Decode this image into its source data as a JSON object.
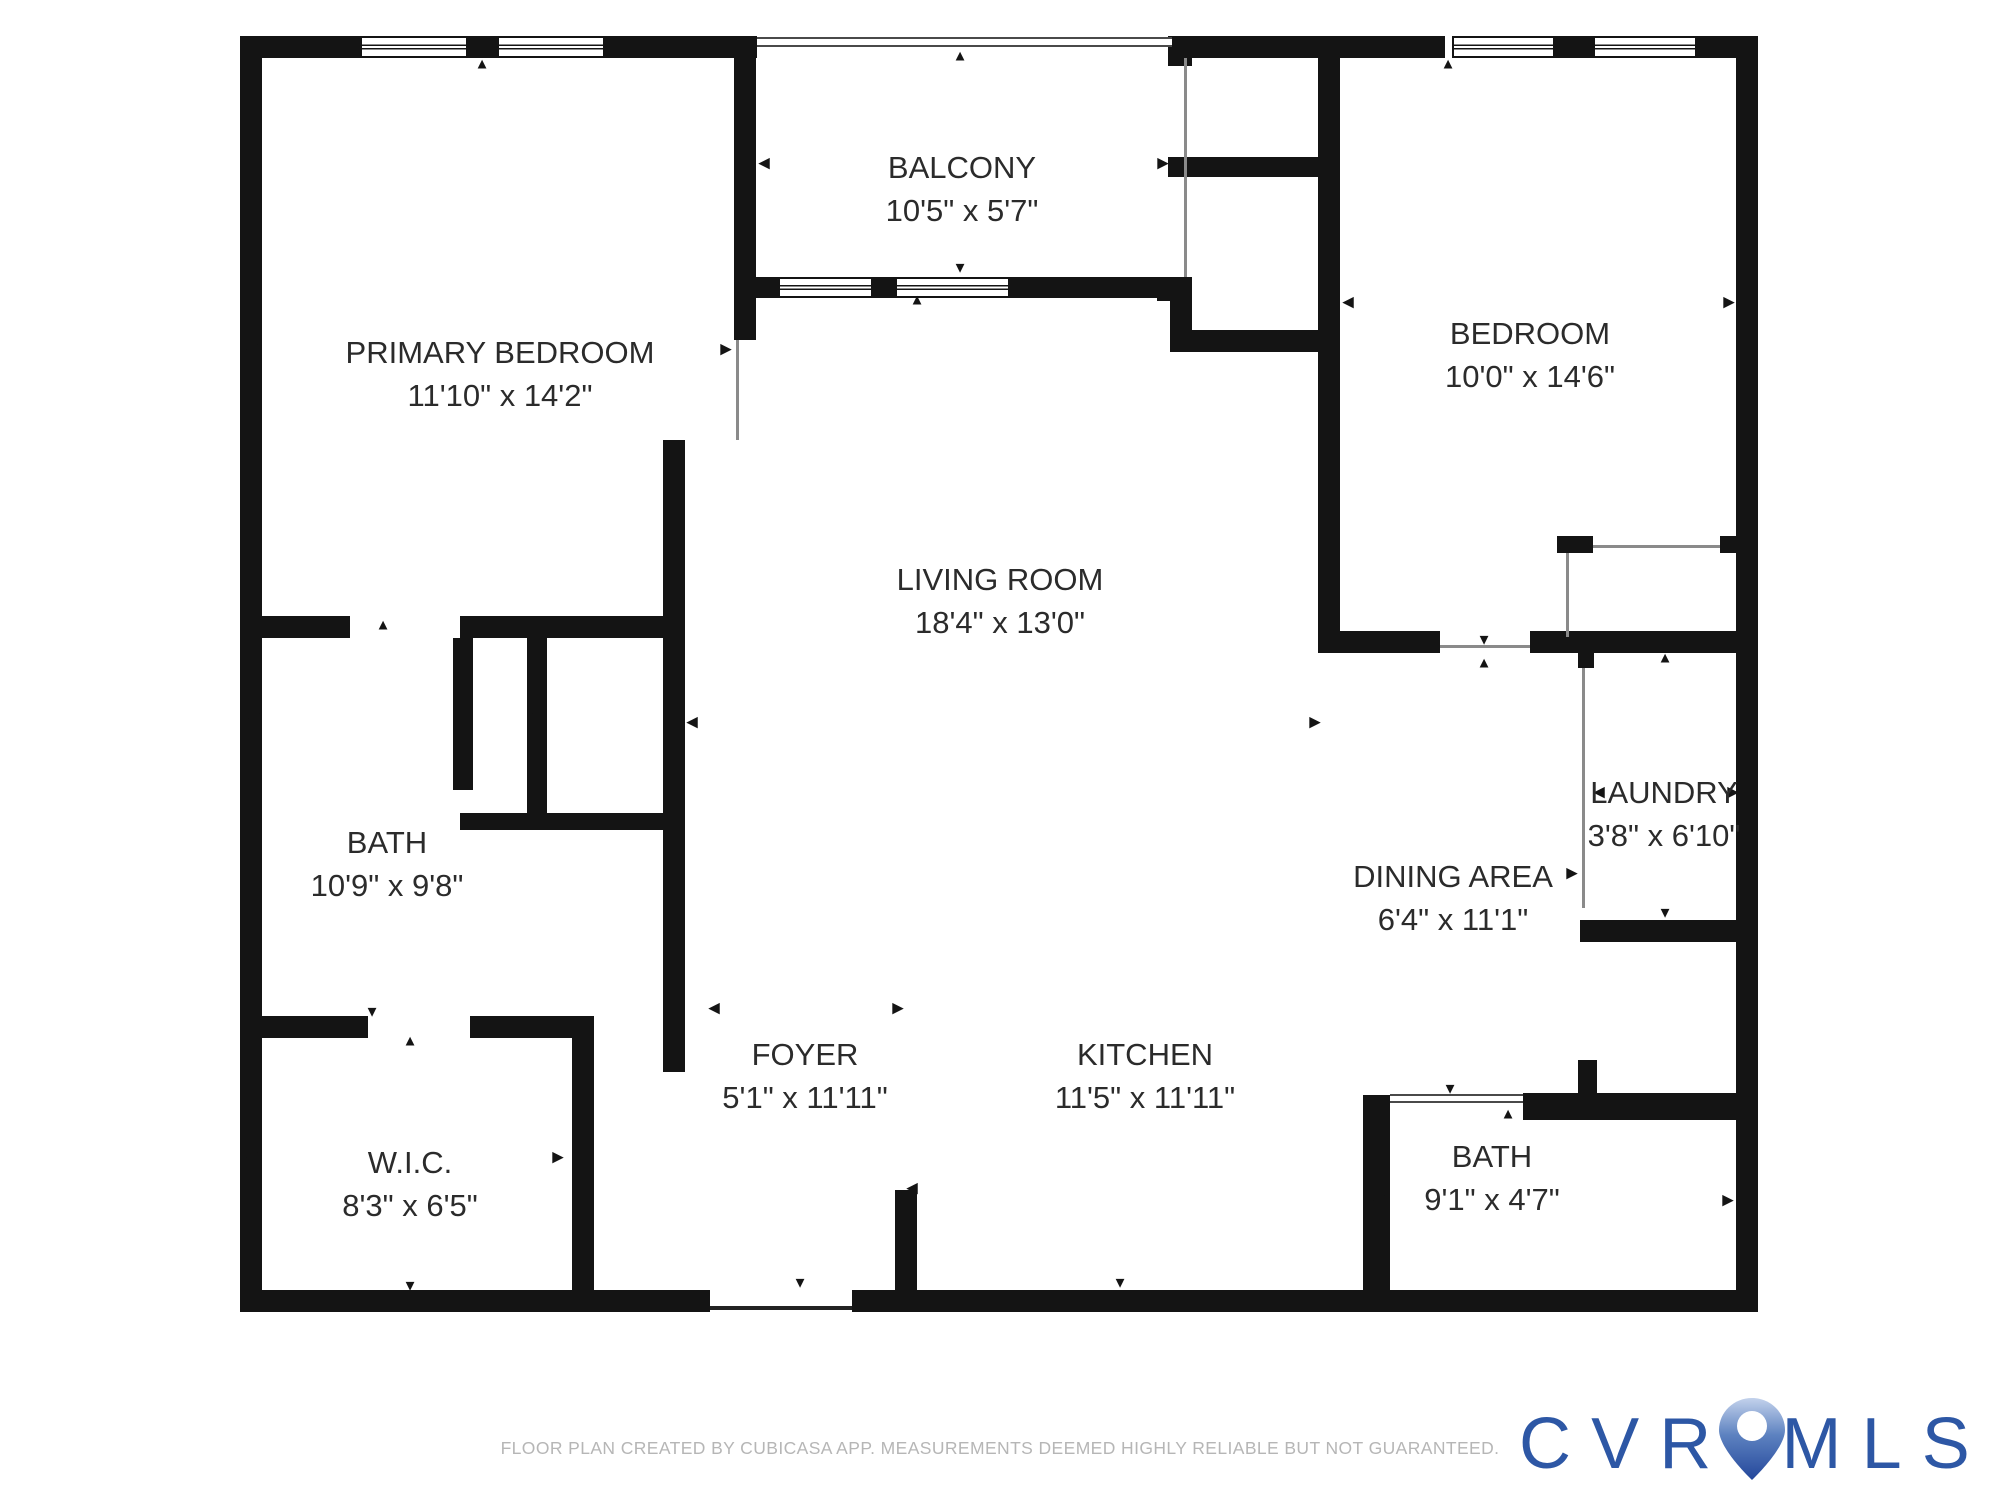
{
  "footer": {
    "disclaimer": "FLOOR PLAN CREATED BY CUBICASA APP. MEASUREMENTS DEEMED HIGHLY RELIABLE BUT NOT GUARANTEED."
  },
  "logo": {
    "left": "CVR",
    "right": "MLS",
    "color": "#2d57a5",
    "pin_icon": "map-pin-icon"
  },
  "plan": {
    "wall_color": "#141414",
    "rooms": [
      {
        "id": "primary-bedroom",
        "name": "PRIMARY BEDROOM",
        "dims": "11'10\" x 14'2\"",
        "cx": 500,
        "cy": 374
      },
      {
        "id": "balcony",
        "name": "BALCONY",
        "dims": "10'5\" x 5'7\"",
        "cx": 962,
        "cy": 189
      },
      {
        "id": "bedroom",
        "name": "BEDROOM",
        "dims": "10'0\" x 14'6\"",
        "cx": 1530,
        "cy": 355
      },
      {
        "id": "living-room",
        "name": "LIVING ROOM",
        "dims": "18'4\" x 13'0\"",
        "cx": 1000,
        "cy": 601
      },
      {
        "id": "bath",
        "name": "BATH",
        "dims": "10'9\" x 9'8\"",
        "cx": 387,
        "cy": 864
      },
      {
        "id": "laundry",
        "name": "LAUNDRY",
        "dims": "3'8\" x 6'10\"",
        "cx": 1664,
        "cy": 814
      },
      {
        "id": "dining-area",
        "name": "DINING AREA",
        "dims": "6'4\" x 11'1\"",
        "cx": 1453,
        "cy": 898
      },
      {
        "id": "foyer",
        "name": "FOYER",
        "dims": "5'1\" x 11'11\"",
        "cx": 805,
        "cy": 1076
      },
      {
        "id": "kitchen",
        "name": "KITCHEN",
        "dims": "11'5\" x 11'11\"",
        "cx": 1145,
        "cy": 1076
      },
      {
        "id": "wic",
        "name": "W.I.C.",
        "dims": "8'3\" x 6'5\"",
        "cx": 410,
        "cy": 1184
      },
      {
        "id": "bath-2",
        "name": "BATH",
        "dims": "9'1\" x 4'7\"",
        "cx": 1492,
        "cy": 1178
      }
    ],
    "walls": [
      [
        240,
        36,
        22,
        1276
      ],
      [
        240,
        36,
        120,
        22
      ],
      [
        468,
        36,
        29,
        22
      ],
      [
        605,
        36,
        152,
        22
      ],
      [
        1172,
        36,
        273,
        22
      ],
      [
        1555,
        36,
        38,
        22
      ],
      [
        1697,
        36,
        61,
        22
      ],
      [
        1736,
        36,
        22,
        1276
      ],
      [
        240,
        1290,
        470,
        22
      ],
      [
        852,
        1290,
        906,
        22
      ],
      [
        734,
        36,
        22,
        304
      ],
      [
        663,
        440,
        22,
        632
      ],
      [
        240,
        616,
        110,
        22
      ],
      [
        460,
        616,
        225,
        22
      ],
      [
        453,
        638,
        20,
        152
      ],
      [
        527,
        638,
        20,
        182
      ],
      [
        460,
        813,
        203,
        17
      ],
      [
        262,
        1016,
        106,
        22
      ],
      [
        470,
        1016,
        124,
        22
      ],
      [
        572,
        1016,
        22,
        274
      ],
      [
        895,
        1190,
        22,
        100
      ],
      [
        734,
        277,
        44,
        21
      ],
      [
        873,
        277,
        22,
        21
      ],
      [
        1010,
        277,
        182,
        21
      ],
      [
        1168,
        36,
        24,
        30
      ],
      [
        1157,
        277,
        35,
        24
      ],
      [
        1170,
        300,
        22,
        52
      ],
      [
        1168,
        157,
        150,
        20
      ],
      [
        1170,
        330,
        148,
        22
      ],
      [
        1318,
        36,
        22,
        617
      ],
      [
        1340,
        631,
        100,
        22
      ],
      [
        1530,
        631,
        206,
        22
      ],
      [
        1557,
        536,
        36,
        17
      ],
      [
        1720,
        536,
        17,
        17
      ],
      [
        1578,
        653,
        16,
        15
      ],
      [
        1580,
        920,
        178,
        22
      ],
      [
        1523,
        1093,
        213,
        27
      ],
      [
        1363,
        1095,
        27,
        195
      ],
      [
        1578,
        1060,
        19,
        35
      ]
    ],
    "windows": [
      [
        360,
        36,
        108,
        22
      ],
      [
        497,
        36,
        108,
        22
      ],
      [
        1452,
        36,
        103,
        22
      ],
      [
        1593,
        36,
        104,
        22
      ],
      [
        778,
        277,
        95,
        21
      ],
      [
        895,
        277,
        115,
        21
      ]
    ],
    "double_lines": [
      [
        757,
        37,
        415,
        10
      ],
      [
        1390,
        1094,
        133,
        9
      ]
    ],
    "thin_lines": [
      {
        "x": 736,
        "y": 340,
        "w": 3,
        "h": 100,
        "dark": false
      },
      {
        "x": 1184,
        "y": 58,
        "w": 3,
        "h": 219,
        "dark": false
      },
      {
        "x": 1582,
        "y": 668,
        "w": 3,
        "h": 240,
        "dark": false
      },
      {
        "x": 1566,
        "y": 553,
        "w": 3,
        "h": 84,
        "dark": false
      },
      {
        "x": 1593,
        "y": 545,
        "w": 127,
        "h": 3,
        "dark": false
      },
      {
        "x": 1440,
        "y": 645,
        "w": 90,
        "h": 3,
        "dark": false
      },
      {
        "x": 710,
        "y": 1306,
        "w": 142,
        "h": 4,
        "dark": true
      }
    ],
    "arrows": [
      {
        "ch": "◀",
        "x": 252,
        "y": 349
      },
      {
        "ch": "▶",
        "x": 726,
        "y": 349
      },
      {
        "ch": "▲",
        "x": 482,
        "y": 64
      },
      {
        "ch": "◀",
        "x": 764,
        "y": 163
      },
      {
        "ch": "▶",
        "x": 1163,
        "y": 163
      },
      {
        "ch": "▲",
        "x": 960,
        "y": 56
      },
      {
        "ch": "▼",
        "x": 960,
        "y": 268
      },
      {
        "ch": "▲",
        "x": 917,
        "y": 300
      },
      {
        "ch": "◀",
        "x": 1348,
        "y": 302
      },
      {
        "ch": "▶",
        "x": 1729,
        "y": 302
      },
      {
        "ch": "▲",
        "x": 1448,
        "y": 64
      },
      {
        "ch": "▼",
        "x": 1484,
        "y": 640
      },
      {
        "ch": "▲",
        "x": 1484,
        "y": 663
      },
      {
        "ch": "▲",
        "x": 383,
        "y": 625
      },
      {
        "ch": "◀",
        "x": 254,
        "y": 718
      },
      {
        "ch": "▶",
        "x": 538,
        "y": 718
      },
      {
        "ch": "◀",
        "x": 692,
        "y": 722
      },
      {
        "ch": "▶",
        "x": 1315,
        "y": 722
      },
      {
        "ch": "▼",
        "x": 372,
        "y": 1012
      },
      {
        "ch": "▲",
        "x": 410,
        "y": 1041
      },
      {
        "ch": "◀",
        "x": 252,
        "y": 1157
      },
      {
        "ch": "▶",
        "x": 558,
        "y": 1157
      },
      {
        "ch": "▼",
        "x": 410,
        "y": 1286
      },
      {
        "ch": "◀",
        "x": 714,
        "y": 1008
      },
      {
        "ch": "▶",
        "x": 898,
        "y": 1008
      },
      {
        "ch": "◀",
        "x": 912,
        "y": 1188
      },
      {
        "ch": "▼",
        "x": 800,
        "y": 1283
      },
      {
        "ch": "▼",
        "x": 1120,
        "y": 1283
      },
      {
        "ch": "▶",
        "x": 1572,
        "y": 873
      },
      {
        "ch": "◀",
        "x": 1599,
        "y": 792
      },
      {
        "ch": "▶",
        "x": 1733,
        "y": 792
      },
      {
        "ch": "▲",
        "x": 1665,
        "y": 658
      },
      {
        "ch": "▼",
        "x": 1665,
        "y": 913
      },
      {
        "ch": "▼",
        "x": 1450,
        "y": 1089
      },
      {
        "ch": "▲",
        "x": 1508,
        "y": 1114
      },
      {
        "ch": "◀",
        "x": 1379,
        "y": 1200
      },
      {
        "ch": "▶",
        "x": 1728,
        "y": 1200
      }
    ]
  }
}
